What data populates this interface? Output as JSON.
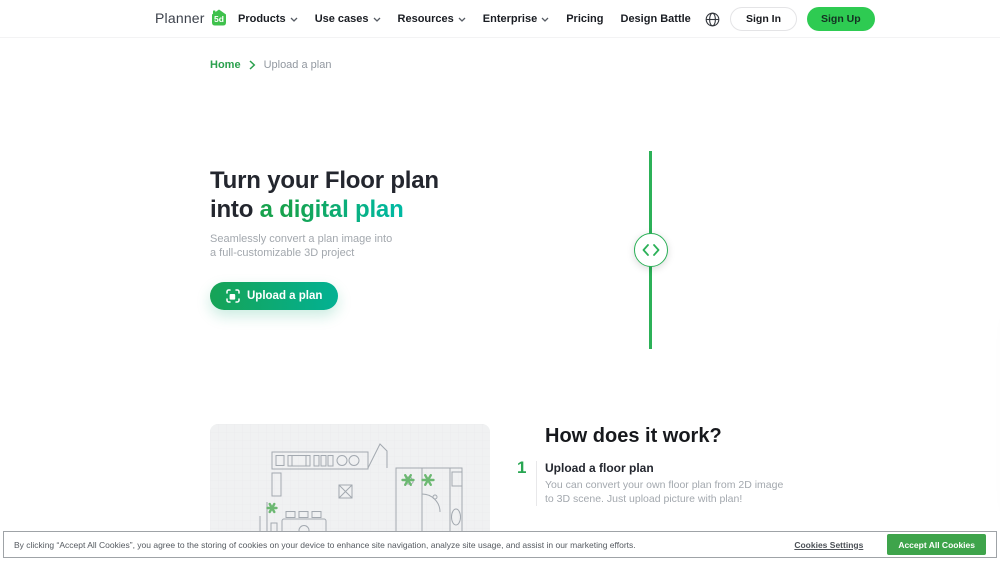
{
  "brand": {
    "name": "Planner",
    "badge": "5d"
  },
  "nav": {
    "items": [
      {
        "label": "Products",
        "dropdown": true
      },
      {
        "label": "Use cases",
        "dropdown": true
      },
      {
        "label": "Resources",
        "dropdown": true
      },
      {
        "label": "Enterprise",
        "dropdown": true
      },
      {
        "label": "Pricing",
        "dropdown": false
      },
      {
        "label": "Design Battle",
        "dropdown": false
      }
    ]
  },
  "auth": {
    "sign_in": "Sign In",
    "sign_up": "Sign Up"
  },
  "breadcrumb": {
    "home": "Home",
    "current": "Upload a plan"
  },
  "hero": {
    "title_line1": "Turn your Floor plan",
    "title_line2_prefix": "into ",
    "title_highlight": "a digital plan",
    "subtitle_line1": "Seamlessly convert a plan image into",
    "subtitle_line2": "a full-customizable 3D project",
    "cta_label": "Upload a plan"
  },
  "how_it_works": {
    "heading": "How does it work?",
    "steps": [
      {
        "number": "1",
        "title": "Upload a floor plan",
        "description_line1": "You can convert your own floor plan from 2D image",
        "description_line2": "to 3D scene. Just upload picture with plan!"
      }
    ]
  },
  "cookie_banner": {
    "message": "By clicking “Accept All Cookies”, you agree to the storing of cookies on your device to enhance site navigation, analyze site usage, and assist in our marketing efforts.",
    "settings_label": "Cookies Settings",
    "accept_label": "Accept All Cookies"
  },
  "colors": {
    "accent_green": "#28a652",
    "accent_teal": "#00b79e",
    "signup_green": "#2ecb52",
    "divider_green": "#2cb158",
    "cookie_accept_green": "#3ea44b"
  }
}
